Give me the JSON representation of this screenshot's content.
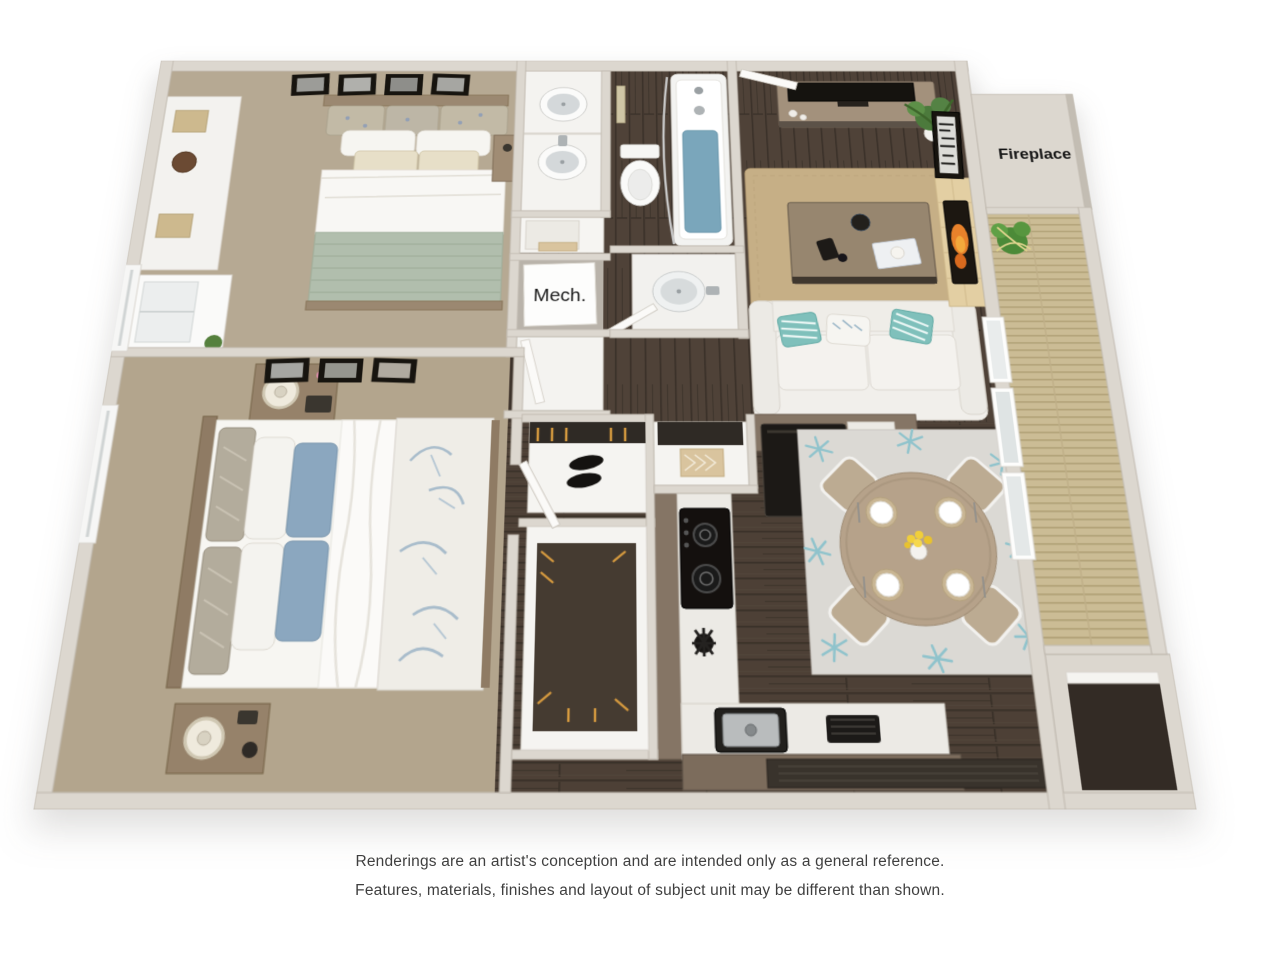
{
  "floorplan": {
    "labels": {
      "fireplace": "Fireplace",
      "mech": "Mech."
    },
    "palette": {
      "background": "#ffffff",
      "wall_top": "#dcd7cf",
      "wall_edge": "#c2bbb1",
      "carpet": "#b5a892",
      "wood_floor_dark": "#4d4036",
      "wood_plank_line": "#393028",
      "balcony_deck": "#cbbc95",
      "deck_slat": "#b2a278",
      "tub_water": "#7aa6bb",
      "sage_blanket": "#b1bead",
      "blue_pillow": "#8ba7bf",
      "teal_pillow": "#7fc0bb",
      "jute_rug": "#c6af86",
      "dining_rug": "#dbd9d4",
      "starfish_teal": "#8fc3cc",
      "fire_orange": "#e8822b",
      "hearth_tile": "#e3cfa3",
      "wood_furniture": "#a3917c",
      "nightstand_wood": "#96826a",
      "fixture_white": "#f4f3f0",
      "appliance_black": "#1c1916",
      "cabinet_brown": "#857565",
      "flower_yellow": "#f0cf3a",
      "plant_green": "#4c7a3c"
    }
  },
  "disclaimer": {
    "line1": "Renderings are an artist's conception and are intended only as a general reference.",
    "line2": "Features, materials, finishes and layout of subject unit may be different than shown."
  }
}
